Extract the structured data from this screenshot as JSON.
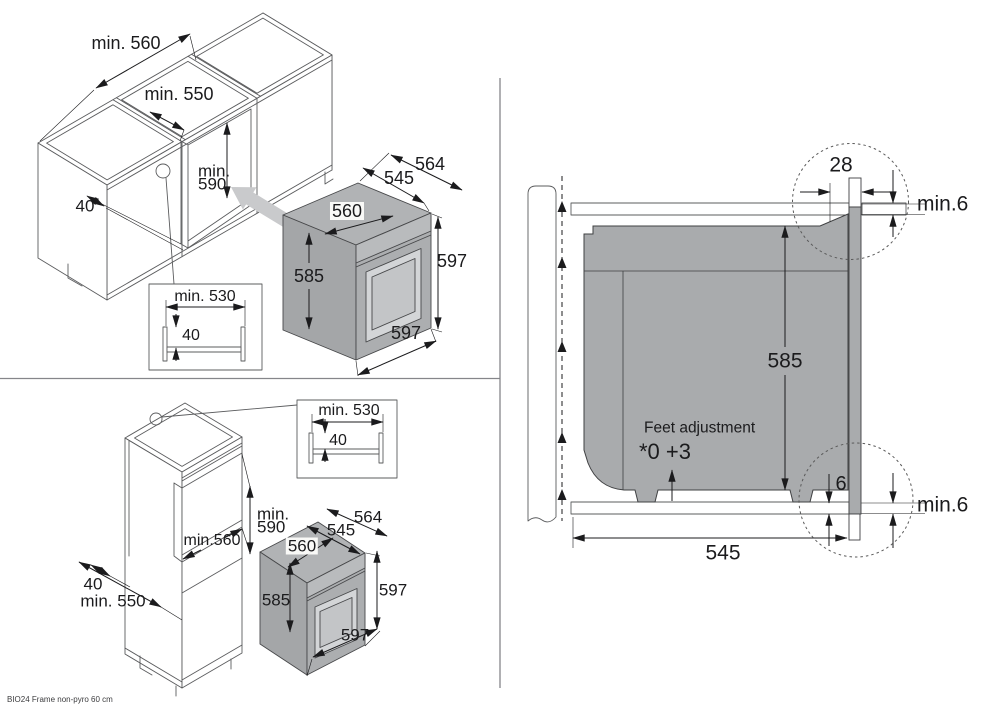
{
  "footer": {
    "model": "BIO24 Frame non-pyro 60 cm"
  },
  "top_left_view": {
    "cabinet": {
      "width_min": "min. 560",
      "inner_width_min": "min. 550",
      "niche_height_line1": "min.",
      "niche_height_line2": "590",
      "rail_width": "40"
    },
    "rail_detail": {
      "width_min": "min. 530",
      "depth": "40"
    },
    "oven": {
      "depth_total": "564",
      "depth_niche": "545",
      "depth_body": "560",
      "height_body": "585",
      "height_total": "597",
      "width_total": "597"
    }
  },
  "bottom_left_view": {
    "cabinet": {
      "niche_height_line1": "min.",
      "niche_height_line2": "590",
      "niche_width_min": "min.560",
      "rail_width": "40",
      "depth_min": "min. 550"
    },
    "rail_detail": {
      "width_min": "min. 530",
      "depth": "40"
    },
    "oven": {
      "depth_total": "564",
      "depth_niche": "545",
      "depth_body": "560",
      "height_body": "585",
      "height_total": "597",
      "width_total": "597"
    }
  },
  "right_view": {
    "frame_overlap": "28",
    "top_clearance": "min.6",
    "oven_height": "585",
    "feet_adjustment_label": "Feet adjustment",
    "feet_adjustment_values": "*0 +3",
    "bottom_frame_gap": "6",
    "bottom_clearance": "min.6",
    "niche_depth": "545"
  }
}
